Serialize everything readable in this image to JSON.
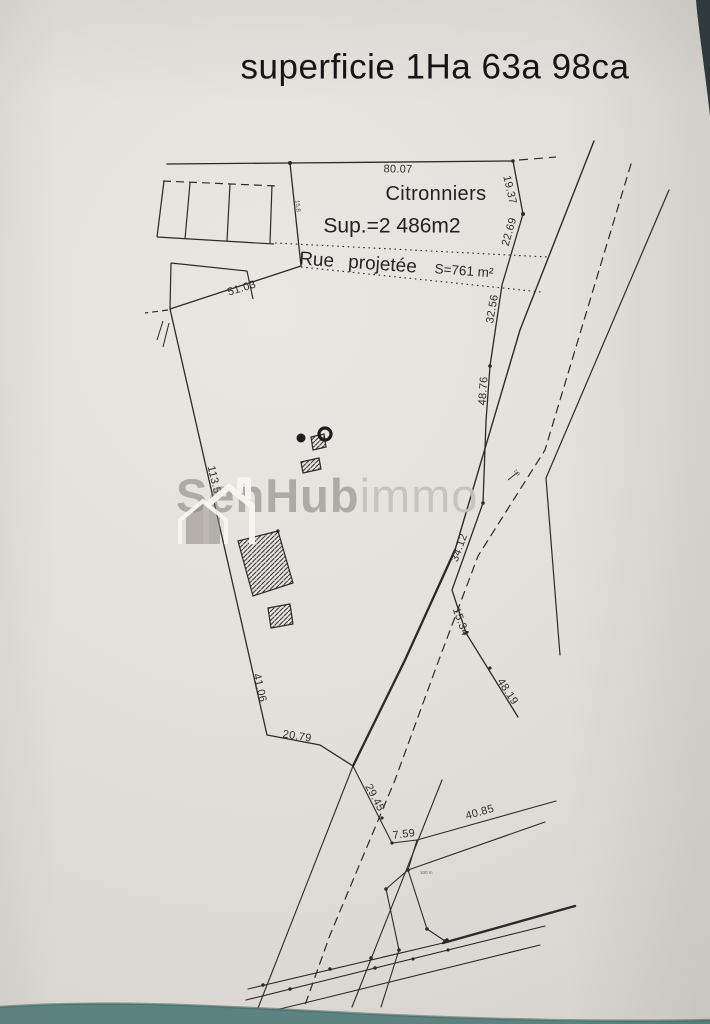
{
  "document": {
    "title": "superficie 1Ha 63a 98ca"
  },
  "parcels": {
    "citronniers": {
      "label": "Citronniers",
      "area": "Sup.=2 486m2"
    },
    "rue_projetee": {
      "label": "Rue projetée",
      "area": "S=761 m²"
    }
  },
  "measurements": {
    "m8007": "80.07",
    "m1937": "19.37",
    "m2269": "22.69",
    "m3256": "32.56",
    "m4876": "48.76",
    "m3412": "34.12",
    "m1534": "15.34",
    "m4819": "48.19",
    "m5103": "51.03",
    "m11354": "113.54",
    "m4106": "41.06",
    "m2079": "20.79",
    "m2945": "29.45",
    "m759": "7.59",
    "m4085": "40.85"
  },
  "micro_labels": {
    "micro1": "15.8",
    "micro2": "1.9",
    "micro3": "100 m"
  },
  "watermark": {
    "bold": "SenHub",
    "light": "immo"
  },
  "symbols": {
    "well": "well-marker (filled dot + ring)",
    "buildings": "hatched-rectangles"
  },
  "colors": {
    "paper": "#e4e1dc",
    "ink": "#2b2b29",
    "table_surface": "#5d8380",
    "corner_shadow": "#2c3a3d",
    "watermark_gray": "#8c8880"
  }
}
